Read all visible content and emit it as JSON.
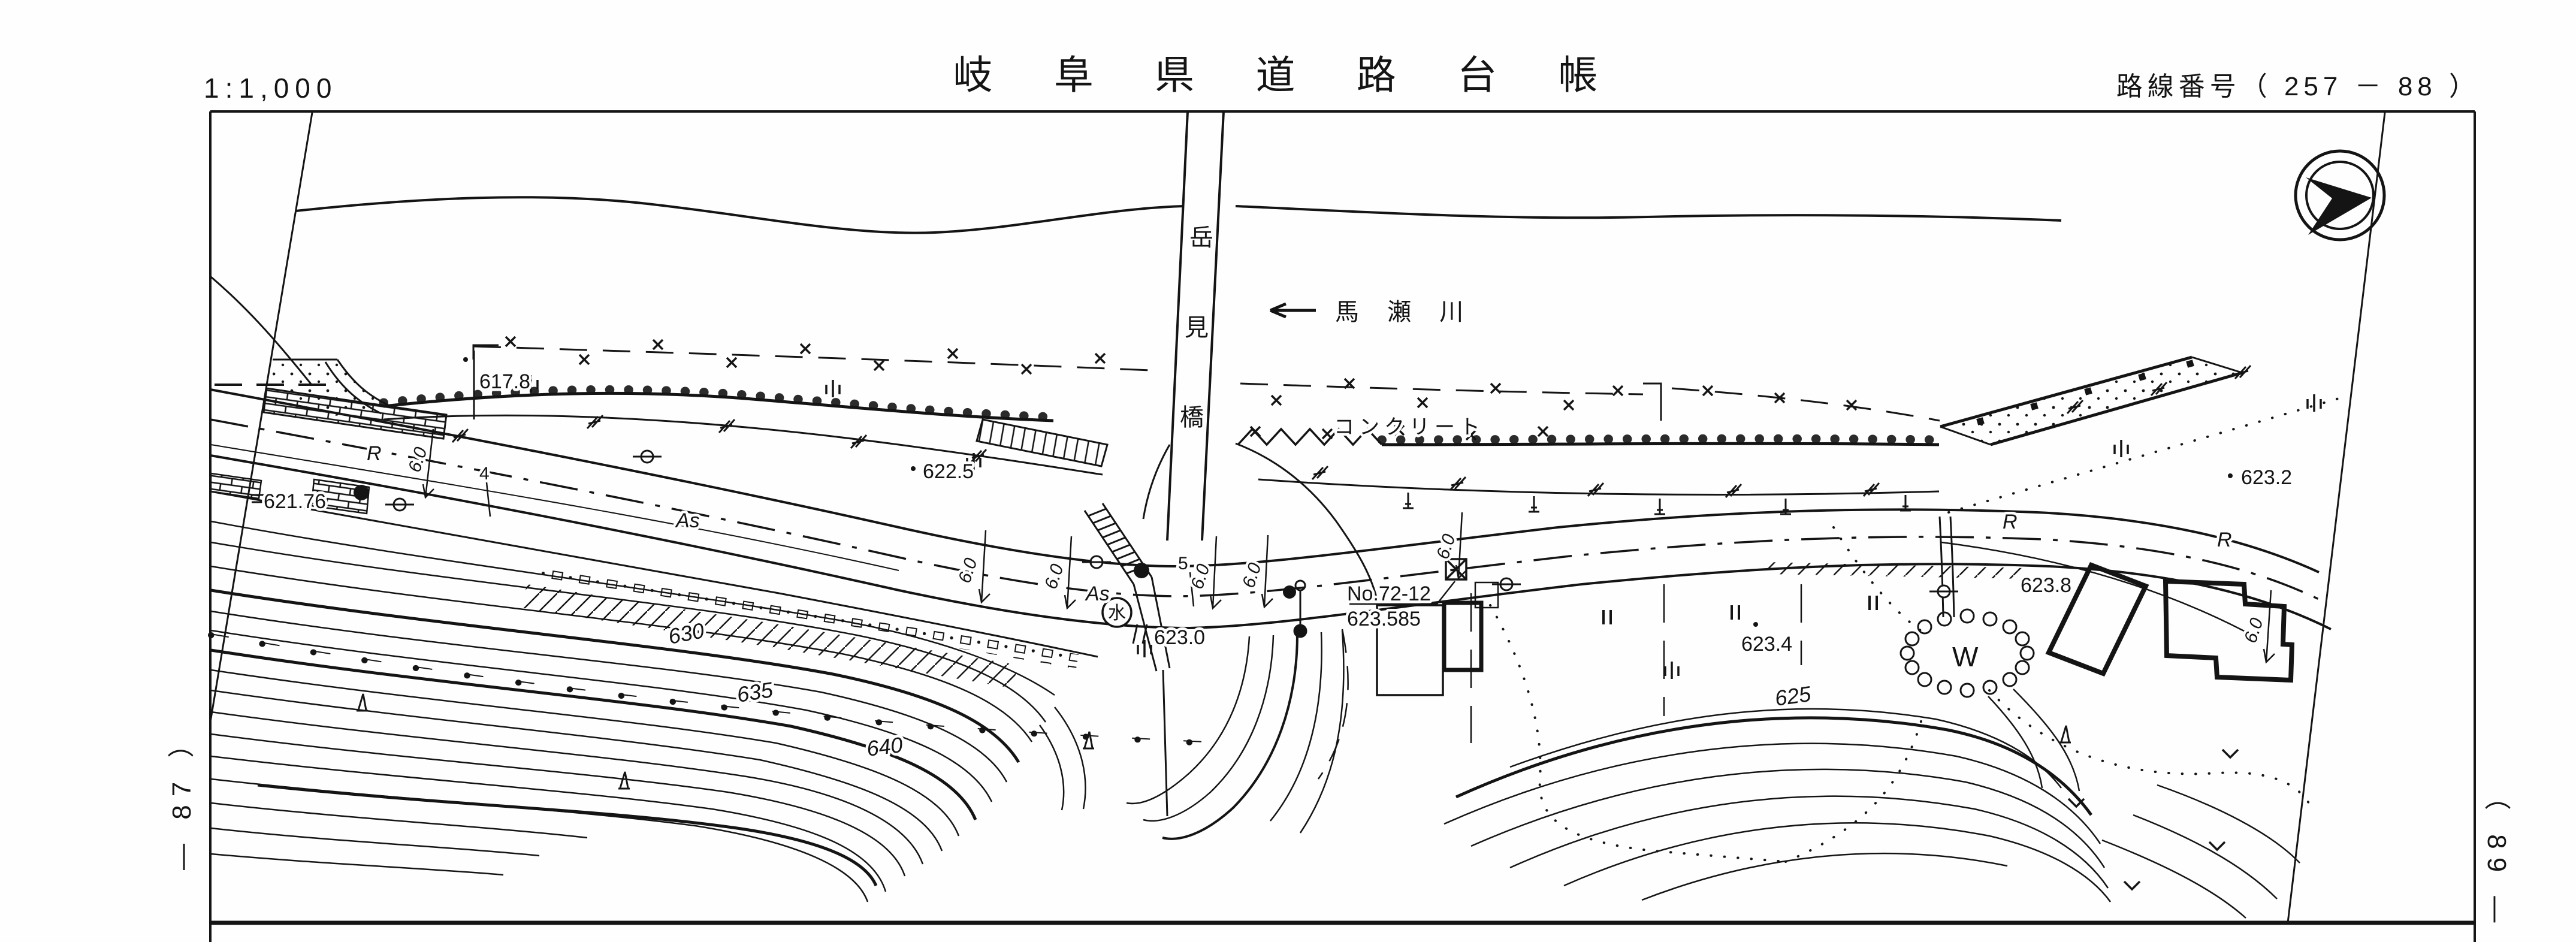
{
  "header": {
    "scale": "1:1,000",
    "title": "岐 阜 県 道 路 台 帳",
    "route_number": "路線番号（ 257 － 88 ）"
  },
  "compass": {
    "icon": "north-arrow-icon"
  },
  "map": {
    "river_name": "馬 瀬 川",
    "bridge_name_chars": [
      "岳",
      "見",
      "橋"
    ],
    "concrete_label": "コンクリート",
    "station": {
      "number": "No.72-12",
      "elevation": "623.585"
    },
    "elev": {
      "e6178": "617.8",
      "e6225": "622.5",
      "e62176": "621.76",
      "e6230": "623.0",
      "e6234": "623.4",
      "e6238": "623.8",
      "e6232": "623.2"
    },
    "contours": {
      "c630": "630",
      "c635": "635",
      "c640": "640",
      "c625": "625"
    },
    "surface": {
      "asphalt": "As",
      "r_mark": "R"
    },
    "width_mark": "6.0",
    "station_ticks": {
      "t4": "4",
      "t5": "5"
    },
    "well": "W",
    "manhole": "水"
  },
  "margins": {
    "left_sheet": "― 87 ）",
    "right_sheet": "（ 89 ―"
  }
}
